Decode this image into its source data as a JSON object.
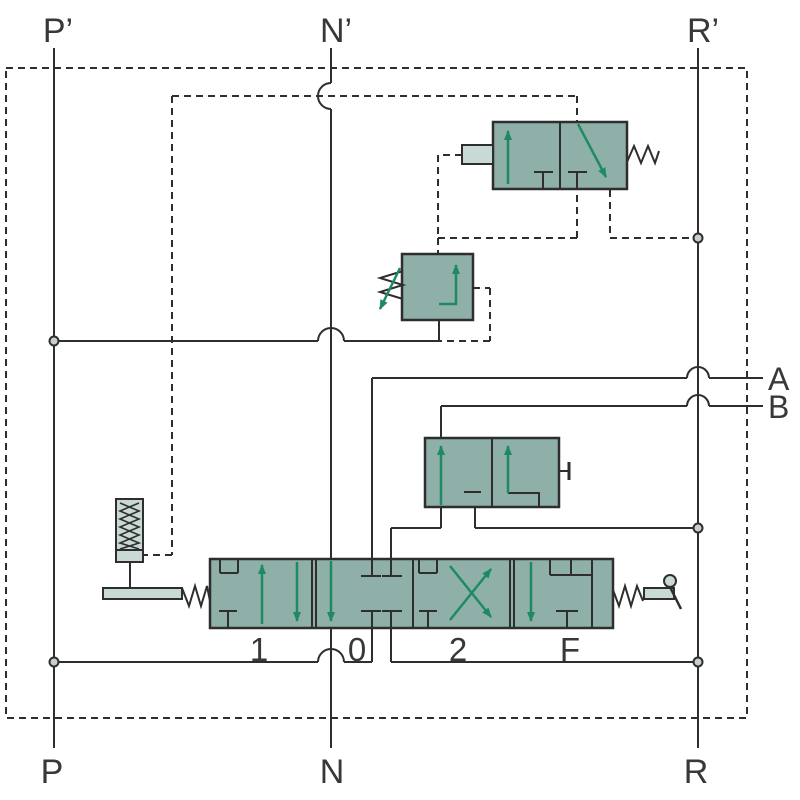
{
  "labels": {
    "rail_top": {
      "p": "P’",
      "n": "N’",
      "r": "R’"
    },
    "rail_bottom": {
      "p": "P",
      "n": "N",
      "r": "R"
    },
    "outputs": {
      "a": "A",
      "b": "B"
    },
    "positions": {
      "p1": "1",
      "p0": "0",
      "p2": "2",
      "pf": "F"
    }
  },
  "colors": {
    "background": "#ffffff",
    "line": "#2e2e2e",
    "valve_fill": "#8fafa9",
    "component_light_fill": "#c9d9d5",
    "arrow_green": "#1e8a64",
    "dot_fill": "#c6cfce",
    "text": "#383838"
  }
}
